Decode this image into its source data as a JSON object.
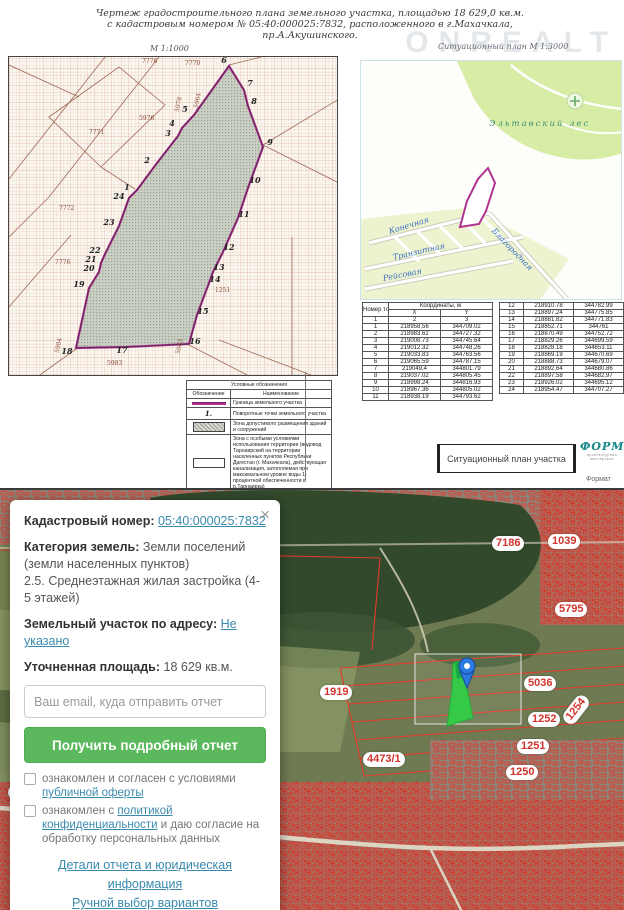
{
  "watermark": "ONREALT",
  "doc": {
    "title_line1": "Чертеж  градостроительного  плана  земельного  участка,     площадью  18 629,0  кв.м.",
    "title_line2": "с  кадастровым  номером     №  05:40:000025:7832,  расположенного  в  г.Махачкала,",
    "title_line3": "пр.А.Акушинского.",
    "scale_main": "М 1:1000",
    "scale_situational": "Ситуационный план М 1:3000",
    "footer_label": "Ситуационный план участка",
    "logo_text": "ФОРМА",
    "logo_subtext": "архитектурная мастерская",
    "format_label": "Формат"
  },
  "plan": {
    "vertices": [
      {
        "n": "1",
        "x": 118,
        "y": 130
      },
      {
        "n": "2",
        "x": 138,
        "y": 103
      },
      {
        "n": "3",
        "x": 159,
        "y": 76
      },
      {
        "n": "4",
        "x": 163,
        "y": 66
      },
      {
        "n": "5",
        "x": 176,
        "y": 52
      },
      {
        "n": "6",
        "x": 215,
        "y": 3
      },
      {
        "n": "7",
        "x": 241,
        "y": 26
      },
      {
        "n": "8",
        "x": 245,
        "y": 44
      },
      {
        "n": "9",
        "x": 261,
        "y": 85
      },
      {
        "n": "10",
        "x": 246,
        "y": 123
      },
      {
        "n": "11",
        "x": 235,
        "y": 157
      },
      {
        "n": "12",
        "x": 220,
        "y": 190
      },
      {
        "n": "13",
        "x": 210,
        "y": 210
      },
      {
        "n": "14",
        "x": 206,
        "y": 222
      },
      {
        "n": "15",
        "x": 194,
        "y": 254
      },
      {
        "n": "16",
        "x": 186,
        "y": 284
      },
      {
        "n": "17",
        "x": 113,
        "y": 293
      },
      {
        "n": "18",
        "x": 58,
        "y": 294
      },
      {
        "n": "19",
        "x": 70,
        "y": 227
      },
      {
        "n": "20",
        "x": 80,
        "y": 211
      },
      {
        "n": "21",
        "x": 82,
        "y": 202
      },
      {
        "n": "22",
        "x": 86,
        "y": 193
      },
      {
        "n": "23",
        "x": 100,
        "y": 165
      },
      {
        "n": "24",
        "x": 110,
        "y": 139
      }
    ],
    "parcel_labels": [
      {
        "text": "7776",
        "x": 133,
        "y": 1,
        "rot": 0
      },
      {
        "text": "7770",
        "x": 176,
        "y": 3,
        "rot": 0
      },
      {
        "text": "5976",
        "x": 130,
        "y": 58,
        "rot": 0
      },
      {
        "text": "5978",
        "x": 162,
        "y": 44,
        "rot": -78
      },
      {
        "text": "5964",
        "x": 181,
        "y": 40,
        "rot": -78
      },
      {
        "text": "7771",
        "x": 80,
        "y": 72,
        "rot": 0
      },
      {
        "text": "7772",
        "x": 50,
        "y": 148,
        "rot": 0
      },
      {
        "text": "7776",
        "x": 46,
        "y": 202,
        "rot": 0
      },
      {
        "text": "1251",
        "x": 206,
        "y": 230,
        "rot": 0
      },
      {
        "text": "5983",
        "x": 98,
        "y": 303,
        "rot": 0
      },
      {
        "text": "5984",
        "x": 42,
        "y": 285,
        "rot": -78
      },
      {
        "text": "5983",
        "x": 163,
        "y": 286,
        "rot": -78
      }
    ]
  },
  "sitplan": {
    "forest_label": "Эльтавский лес",
    "streets": [
      {
        "name": "Конечная",
        "x": 28,
        "y": 166,
        "rot": -17
      },
      {
        "name": "Транзитная",
        "x": 32,
        "y": 192,
        "rot": -13
      },
      {
        "name": "Рейсовая",
        "x": 22,
        "y": 213,
        "rot": -11
      },
      {
        "name": "Благородная",
        "x": 132,
        "y": 164,
        "rot": 46
      }
    ]
  },
  "points_table": {
    "col_point": "Номер точки",
    "col_coords": "Координаты, м",
    "col_x": "X",
    "col_y": "Y",
    "index_row": [
      "1",
      "2",
      "3"
    ],
    "rows_left": [
      [
        "1",
        "218958.56",
        "344709.02"
      ],
      [
        "2",
        "218983.62",
        "344727.32"
      ],
      [
        "3",
        "219008.73",
        "344745.64"
      ],
      [
        "4",
        "219012.32",
        "344748.26"
      ],
      [
        "5",
        "219033.83",
        "344763.56"
      ],
      [
        "6",
        "219065.59",
        "344787.15"
      ],
      [
        "7",
        "219049.4",
        "344801.79"
      ],
      [
        "8",
        "219037.02",
        "344805.45"
      ],
      [
        "9",
        "218998.24",
        "344816.93"
      ],
      [
        "10",
        "218967.36",
        "344805.02"
      ],
      [
        "11",
        "218938.19",
        "344793.62"
      ]
    ],
    "rows_right": [
      [
        "12",
        "218910.78",
        "344782.99"
      ],
      [
        "13",
        "218897.24",
        "344775.85"
      ],
      [
        "14",
        "218881.82",
        "344771.83"
      ],
      [
        "15",
        "218852.71",
        "344761"
      ],
      [
        "16",
        "218870.49",
        "344752.72"
      ],
      [
        "17",
        "218829.26",
        "344699.59"
      ],
      [
        "18",
        "218828.18",
        "344653.11"
      ],
      [
        "19",
        "218869.19",
        "344670.69"
      ],
      [
        "20",
        "218888.73",
        "344679.07"
      ],
      [
        "21",
        "218892.64",
        "344680.86"
      ],
      [
        "22",
        "218897.58",
        "344682.97"
      ],
      [
        "23",
        "218926.02",
        "344695.12"
      ],
      [
        "24",
        "218954.47",
        "344707.27"
      ]
    ]
  },
  "legend": {
    "title": "Условные обозначения",
    "col_symbol": "Обозначение",
    "col_name": "Наименование",
    "rows": [
      {
        "symbol": "boundary-line",
        "symbol_text": "",
        "name": "Граница земельного участка"
      },
      {
        "symbol": "turn-point",
        "symbol_text": "1.",
        "name": "Поворотные точки земельного участка"
      },
      {
        "symbol": "hatched-area",
        "symbol_text": "",
        "name": "Зона допустимого размещения зданий и сооружений"
      },
      {
        "symbol": "special-zone",
        "symbol_text": "",
        "name": "Зона с особыми условиями использования территории (водовод Тарнаирский на территории населенных пунктов Республики Дагестан (г. Махачкала), действующая канализация, затопляемая при максимальном уровне воды 1-процентной обеспеченности в р.Тарнаирка)"
      }
    ]
  },
  "map": {
    "labels": [
      {
        "text": "7186",
        "x": 492,
        "y": 46,
        "rot": 0
      },
      {
        "text": "1039",
        "x": 548,
        "y": 44,
        "rot": 0
      },
      {
        "text": "5795",
        "x": 555,
        "y": 112,
        "rot": 0
      },
      {
        "text": "5036",
        "x": 524,
        "y": 186,
        "rot": 0
      },
      {
        "text": "1252",
        "x": 528,
        "y": 222,
        "rot": 0
      },
      {
        "text": "1254",
        "x": 560,
        "y": 212,
        "rot": -52
      },
      {
        "text": "1251",
        "x": 517,
        "y": 249,
        "rot": 0
      },
      {
        "text": "1250",
        "x": 506,
        "y": 275,
        "rot": 0
      },
      {
        "text": "1919",
        "x": 320,
        "y": 195,
        "rot": 0
      },
      {
        "text": "4473/1",
        "x": 363,
        "y": 262,
        "rot": 0
      },
      {
        "text": "3035",
        "x": 8,
        "y": 295,
        "rot": 0
      },
      {
        "text": "7329",
        "x": 86,
        "y": 291,
        "rot": 0
      },
      {
        "text": "7330",
        "x": 81,
        "y": 325,
        "rot": 0
      },
      {
        "text": "3096",
        "x": 146,
        "y": 298,
        "rot": -70
      },
      {
        "text": "3097",
        "x": 245,
        "y": 299,
        "rot": 0
      },
      {
        "text": "84",
        "x": 238,
        "y": 315,
        "rot": 0
      },
      {
        "text": "123",
        "x": 62,
        "y": 364,
        "rot": -72
      }
    ]
  },
  "card": {
    "close_icon": "×",
    "cadastral_label": "Кадастровый номер:",
    "cadastral_value": "05:40:000025:7832",
    "category_label": "Категория земель:",
    "category_value": "Земли поселений (земли населенных пунктов)",
    "category_detail": "2.5. Среднеэтажная жилая застройка (4-5 этажей)",
    "address_label": "Земельный участок по адресу:",
    "address_value": "Не указано",
    "area_label": "Уточненная площадь:",
    "area_value": "18 629 кв.м.",
    "email_placeholder": "Ваш email, куда отправить отчет",
    "button_label": "Получить подробный отчет",
    "checkbox1_prefix": "ознакомлен и согласен с условиями ",
    "checkbox1_link": "публичной оферты",
    "checkbox2_prefix": "ознакомлен с ",
    "checkbox2_link": "политикой конфиденциальности",
    "checkbox2_suffix": " и даю согласие на обработку персональных данных",
    "link_details": "Детали отчета и юридическая информация",
    "link_manual": "Ручной выбор вариантов"
  },
  "colors": {
    "parcel_boundary": "#a8308c",
    "map_label_red": "#d0342c",
    "button_green": "#5cb85c",
    "link_teal": "#3a8aad",
    "forest_green": "#d7eda6",
    "selected_parcel_green": "#2fcf46",
    "pin_blue": "#2a7ae0"
  }
}
